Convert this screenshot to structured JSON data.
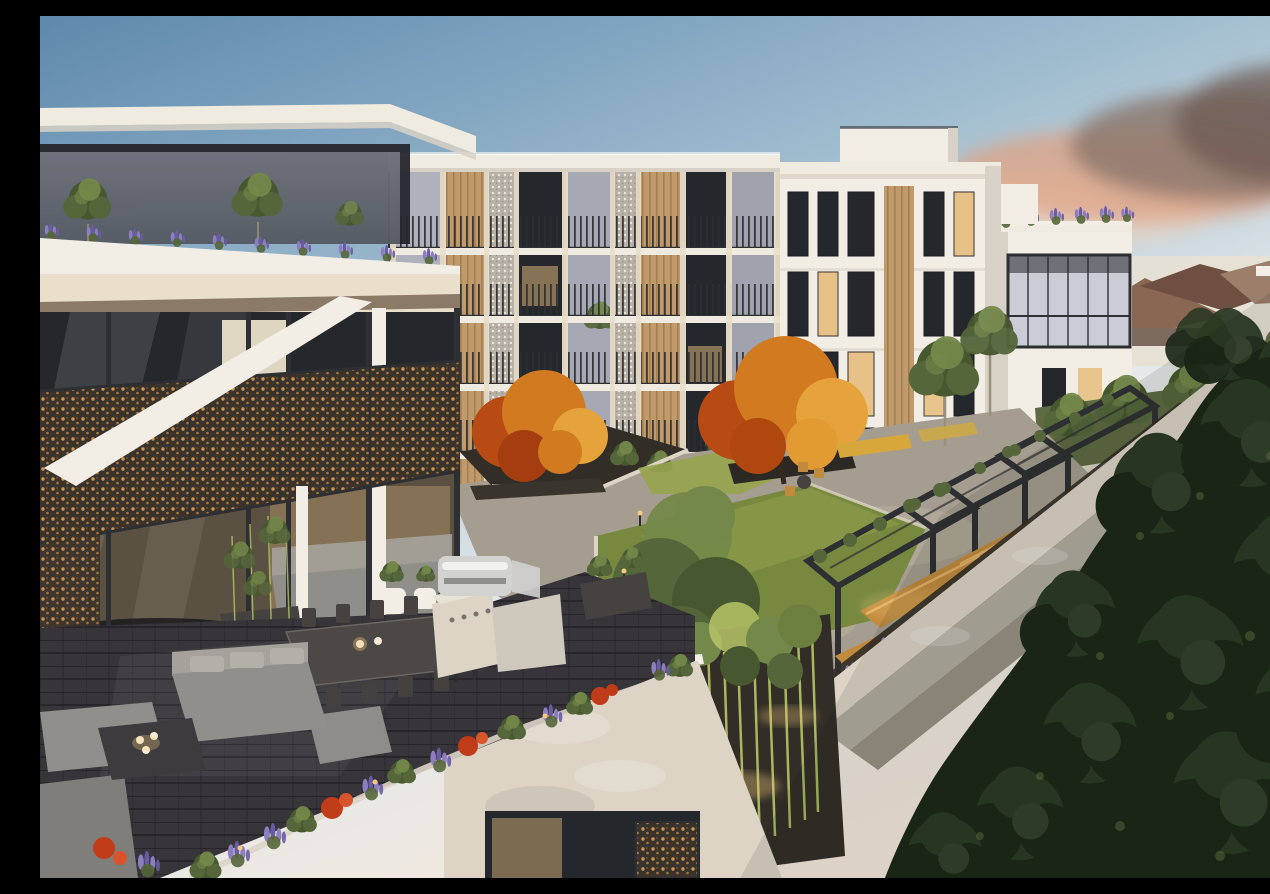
{
  "meta": {
    "kind": "architectural-render-photo",
    "width_px": 1270,
    "height_px": 862,
    "visible_text": []
  },
  "palette": {
    "skyTop": "#5d89ad",
    "skyMid": "#9fbccf",
    "skyLight": "#e4e9ea",
    "skyWarm": "#f4e8dc",
    "cloudPink": "#dfa183",
    "cloudMauve": "#8a746a",
    "cloudLight": "#eed3bd",
    "wallWhite": "#f2eee6",
    "wallShade": "#d8d1c5",
    "wallWarm": "#eadfca",
    "roofFascia": "#f0ebe1",
    "glassDark": "#24272c",
    "glassReflect": "#c3c6d2",
    "glassWarm": "#e8bd7e",
    "timber": "#c19a6b",
    "timberDark": "#9b7a4c",
    "railDark": "#2e2f32",
    "screenSilver": "#b6b0a7",
    "ornBase": "#3a332c",
    "ornGlow": "#d99d55",
    "lawn": "#77893f",
    "lawnLit": "#97a44e",
    "shrubGreen": "#55663a",
    "leafLit": "#74884a",
    "treeGreen": "#47572f",
    "treeDark": "#2c3a24",
    "treeDeep": "#1c2818",
    "autumnOrange": "#d17a20",
    "autumnRed": "#b84a14",
    "autumnGold": "#e7a33b",
    "lavender": "#8d7dc1",
    "lavenderDeep": "#6a5ba5",
    "flowerRed": "#c03c18",
    "concrete": "#b3aca0",
    "concreteLit": "#ddd4c6",
    "pathStone": "#a59d90",
    "soilDark": "#322e27",
    "terraceTile": "#37353a",
    "tileLine": "#232126",
    "furnGray": "#908f8b",
    "furnLight": "#a5a29c",
    "furnDark": "#454240",
    "steel": "#d2d2d0",
    "woodBench": "#c18a3d",
    "glowWarm": "#f5c97f",
    "suburbRoof": "#8a6753",
    "suburbRoof2": "#6e4f41",
    "hazeWarm": "#e9e0d2",
    "bamboo": "#b7c666",
    "bambooDark": "#6d7f3e"
  },
  "scene": {
    "description_elements": [
      "dusk-sky",
      "sunset-clouds",
      "suburban-skyline",
      "apartment-wing-right",
      "glass-balcony",
      "rooftop-garden-right",
      "apartment-block-center",
      "window-grid",
      "balcony-facade",
      "timber-slat-panels",
      "perforated-screen-columns",
      "rooftop-terrace-left",
      "olive-trees",
      "lavender-parapet",
      "courtyard-garden",
      "lawn",
      "autumn-trees",
      "pergola-dining-area",
      "timber-benches",
      "boundary-wall",
      "lavender-garden-bed",
      "bamboo-grove",
      "penthouse-terrace",
      "decorative-bronze-screen",
      "indoor-lounge",
      "outdoor-dining-set",
      "outdoor-lounge-set",
      "coffee-table",
      "bbq-kitchen",
      "white-planter-pots",
      "terrace-flower-planter",
      "parapet-wall",
      "foreground-trees"
    ]
  }
}
